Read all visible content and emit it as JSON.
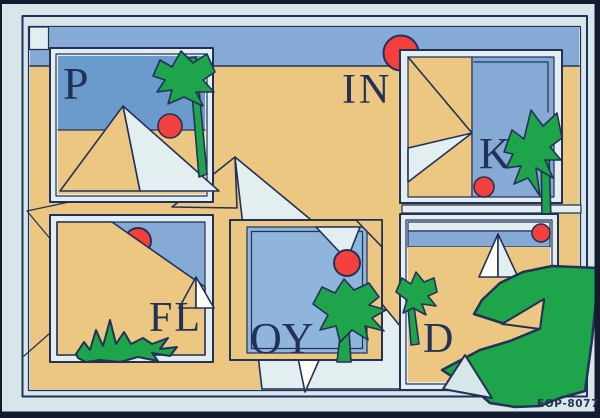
{
  "artwork": {
    "description": "rebus-art-print",
    "title_letters": {
      "p": "P",
      "in": "IN",
      "k": "K",
      "fl": "FL",
      "oy": "OY",
      "d": "D"
    },
    "print_code": "EOP-80778"
  },
  "palette": {
    "card": "#d7e6e9",
    "photo_edge": "#141b30",
    "navy": "#233158",
    "sand": "#ecc782",
    "sky_band": "#84aad5",
    "sky_deep": "#6b9bcd",
    "sky_light": "#8fb5dc",
    "pale": "#e2eef0",
    "white": "#fdfef7",
    "green": "#1ea44b",
    "red": "#f4403c"
  }
}
